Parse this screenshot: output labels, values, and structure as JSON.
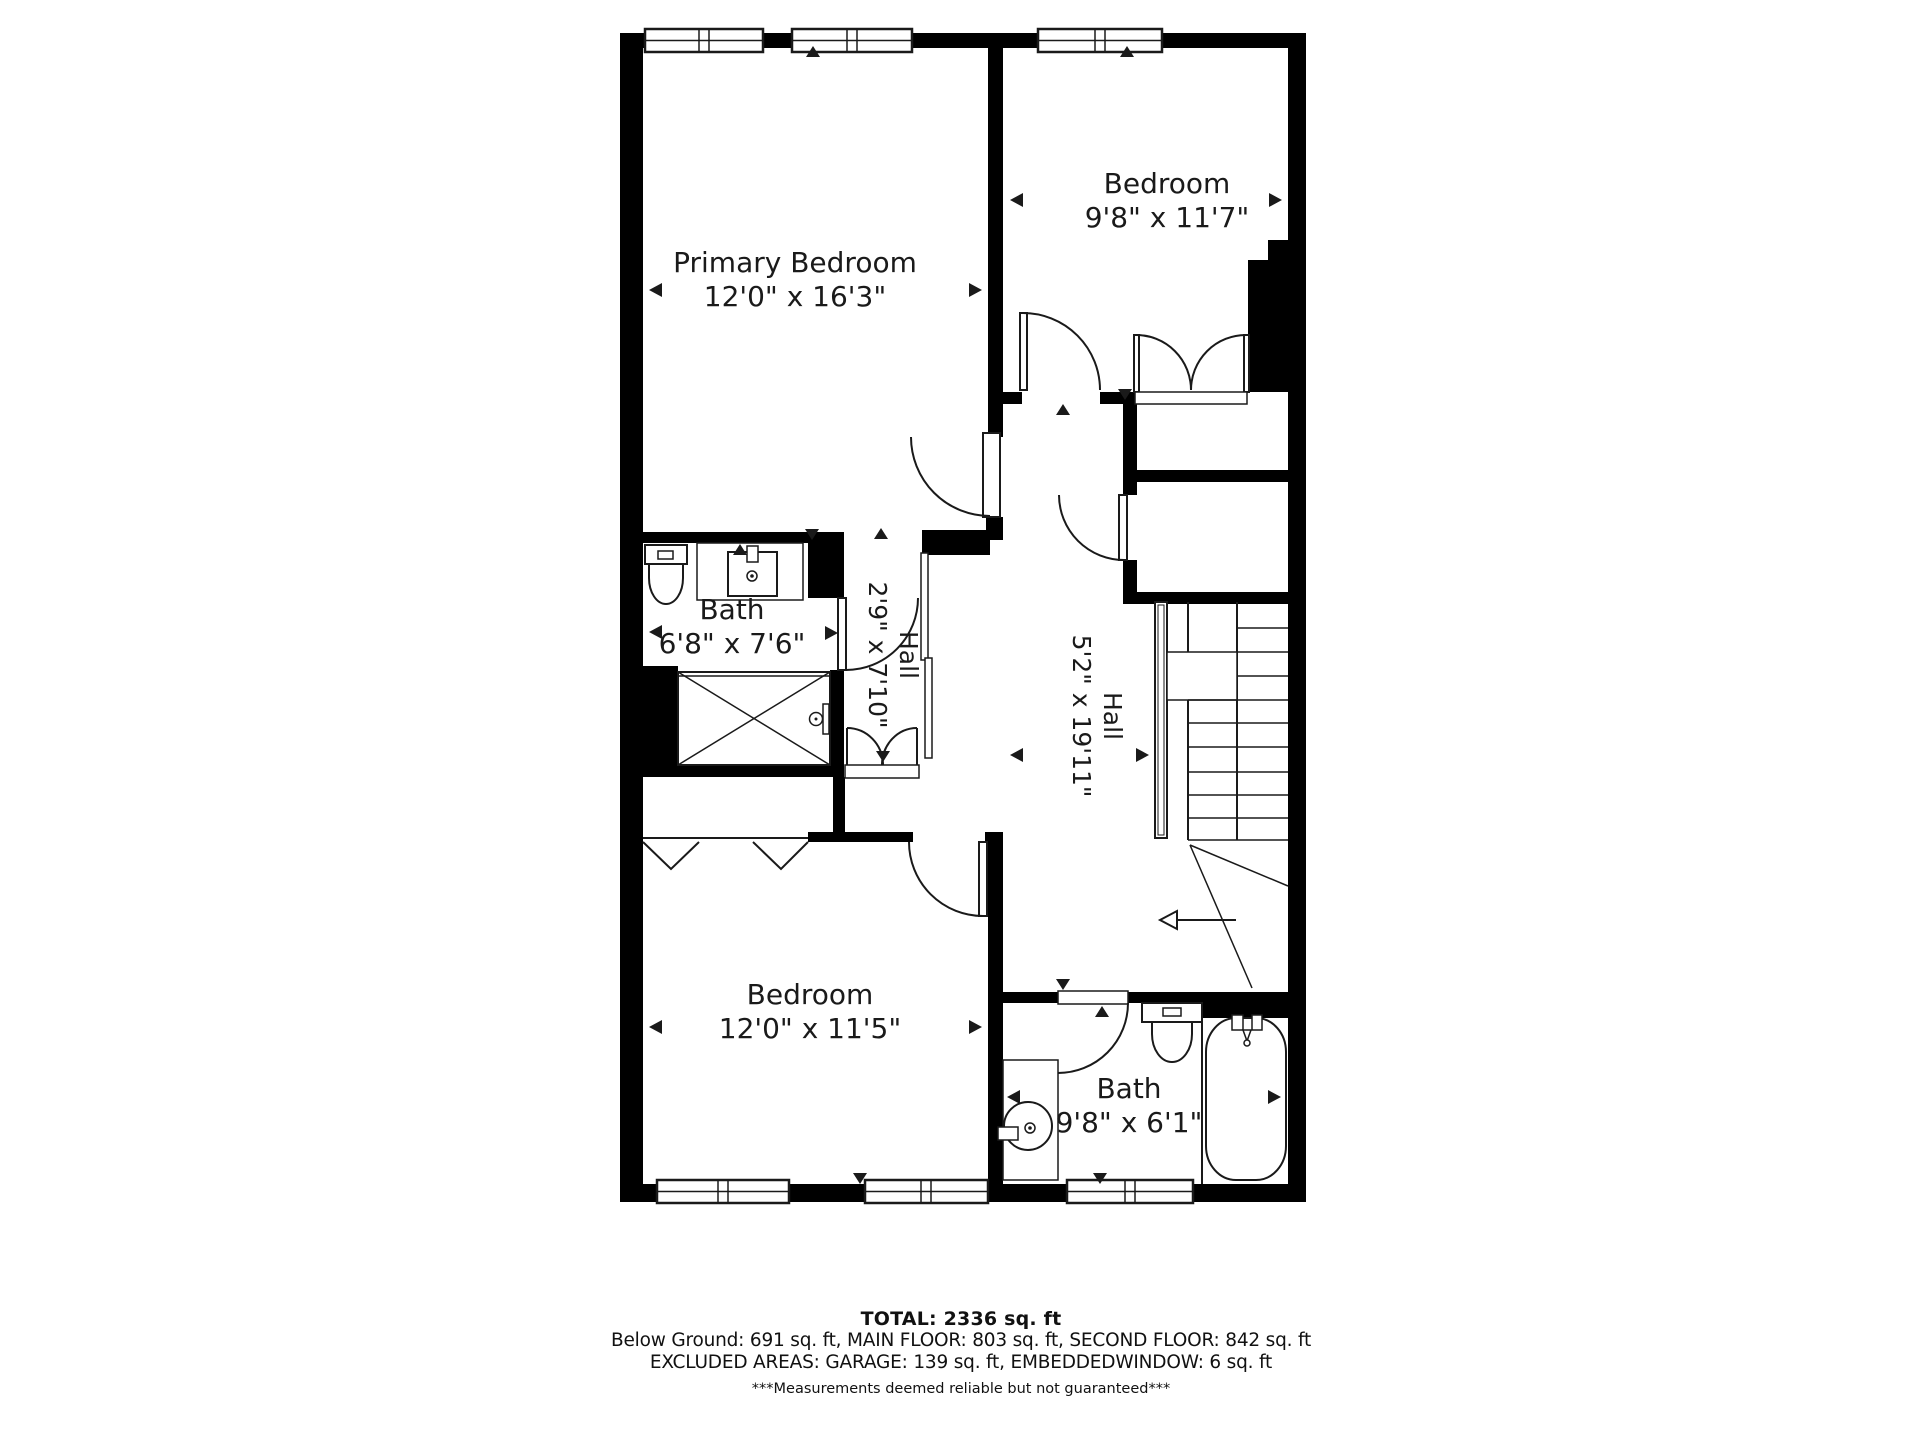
{
  "plan": {
    "rooms": [
      {
        "name": "Primary Bedroom",
        "dims": "12'0\" x 16'3\""
      },
      {
        "name": "Bedroom",
        "dims": "9'8\" x 11'7\""
      },
      {
        "name": "Bath",
        "dims": "6'8\" x 7'6\""
      },
      {
        "name": "Hall",
        "dims": "2'9\" x 7'10\""
      },
      {
        "name": "Hall",
        "dims": "5'2\" x 19'11\""
      },
      {
        "name": "Bedroom",
        "dims": "12'0\" x 11'5\""
      },
      {
        "name": "Bath",
        "dims": "9'8\" x 6'1\""
      }
    ],
    "colors": {
      "wall": "#000000",
      "line": "#1a1a1a",
      "background": "#ffffff"
    }
  },
  "footer": {
    "total": "TOTAL: 2336 sq. ft",
    "floors": "Below Ground: 691 sq. ft, MAIN FLOOR: 803 sq. ft, SECOND FLOOR: 842 sq. ft",
    "excluded": "EXCLUDED AREAS: GARAGE: 139 sq. ft, EMBEDDEDWINDOW: 6 sq. ft",
    "disclaimer": "***Measurements deemed reliable but not guaranteed***"
  }
}
